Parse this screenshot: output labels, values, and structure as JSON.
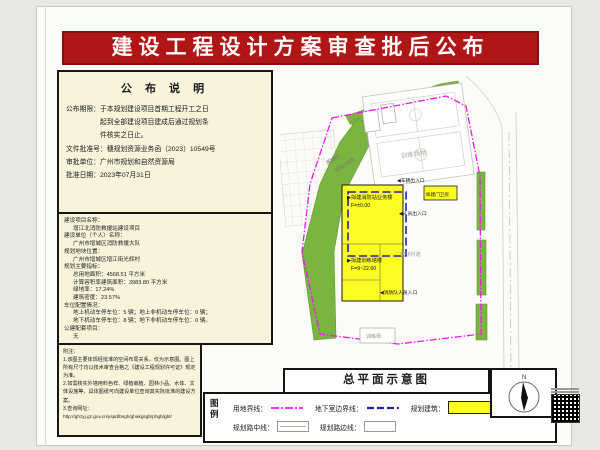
{
  "page": {
    "title": "建设工程设计方案审查批后公布"
  },
  "notice": {
    "header": "公 布 说 明",
    "period1": "公布期限：于本规划建设项目首期工程开工之日",
    "period2": "起到全部建设项目建成后通过规划条",
    "period3": "件核实之日止。",
    "doc_no": "文件批准号：穗规划资源业务函〔2023〕10549号",
    "authority": "审批单位：广州市规划和自然资源局",
    "date": "批准日期：2023年07月31日"
  },
  "project": {
    "name_label": "建设项目名称：",
    "name": "增江北消防救援站建设项目",
    "owner_label": "建设单位（个人）名称：",
    "owner": "广州市增城区消防救援大队",
    "location_label": "规划地块位置：",
    "location": "广州市增城区增江街光辉村",
    "indicators_label": "规划主要指标：",
    "site_area": "总用地面积：4568.51 平方米",
    "floor_area": "计算容积率建筑面积：3983.80 平方米",
    "green_ratio": "绿地率：17.24%",
    "density": "建筑密度：23.57%",
    "parking_label": "车位配置情况：",
    "parking1": "地上机动车停车位：5 辆；地上非机动车停车位：0 辆；",
    "parking2": "地下机动车停车位：8 辆；地下非机动车停车位：0 辆。",
    "public_label": "公建配套项目：",
    "public_value": "无"
  },
  "notes": {
    "header": "附注：",
    "n1": "1.该图主要体现经批准的空间布局关系，仅为示意图。图上所有尺寸均以技术审查合格之《建设工程规划许可证》规定为准。",
    "n2": "2.如需核实外墙用料色样、绿植栽植、园林小品、水体、文体设施等，具体图纸可向建设单位查询其实际批准的建设方案。",
    "n3": "3.查询网址：",
    "url": "http://ghzyj.gz.gov.cn/yspd/bsgh/ghakgsgb/phgb/gbt/"
  },
  "plan": {
    "title": "总平面示意图",
    "north": "N",
    "labels": {
      "training_ground": "训练场地",
      "wall_line": "围墙线",
      "planned_road": "规划7米路",
      "bldg1": "▶拟建消防站业务楼",
      "bldg1_f": "F=±0.00",
      "tower": "▶拟建训练塔楼",
      "tower_f": "F=9~22.60",
      "gate": "拟建门卫房",
      "entrance_vehicle": "◀车辆出入口",
      "entrance_staff": "◀人员出入口",
      "entrance_fire": "◀消防队人员入口",
      "existing_road": "现状村道",
      "training_small": "训练场"
    }
  },
  "legend": {
    "col_char1": "图",
    "col_char2": "例",
    "site_boundary": "用地界线：",
    "basement_line": "地下室边界线：",
    "planned_building": "规划建筑：",
    "green_space": "绿地：",
    "road_center": "规划路中线：",
    "road_edge": "规划路边线："
  },
  "colors": {
    "banner_red": "#b01616",
    "panel_cream": "#f8f4dc",
    "building_yellow": "#fcfc25",
    "green_space": "#7ab441",
    "site_boundary_magenta": "#f317f3",
    "basement_blue": "#2222a8"
  }
}
